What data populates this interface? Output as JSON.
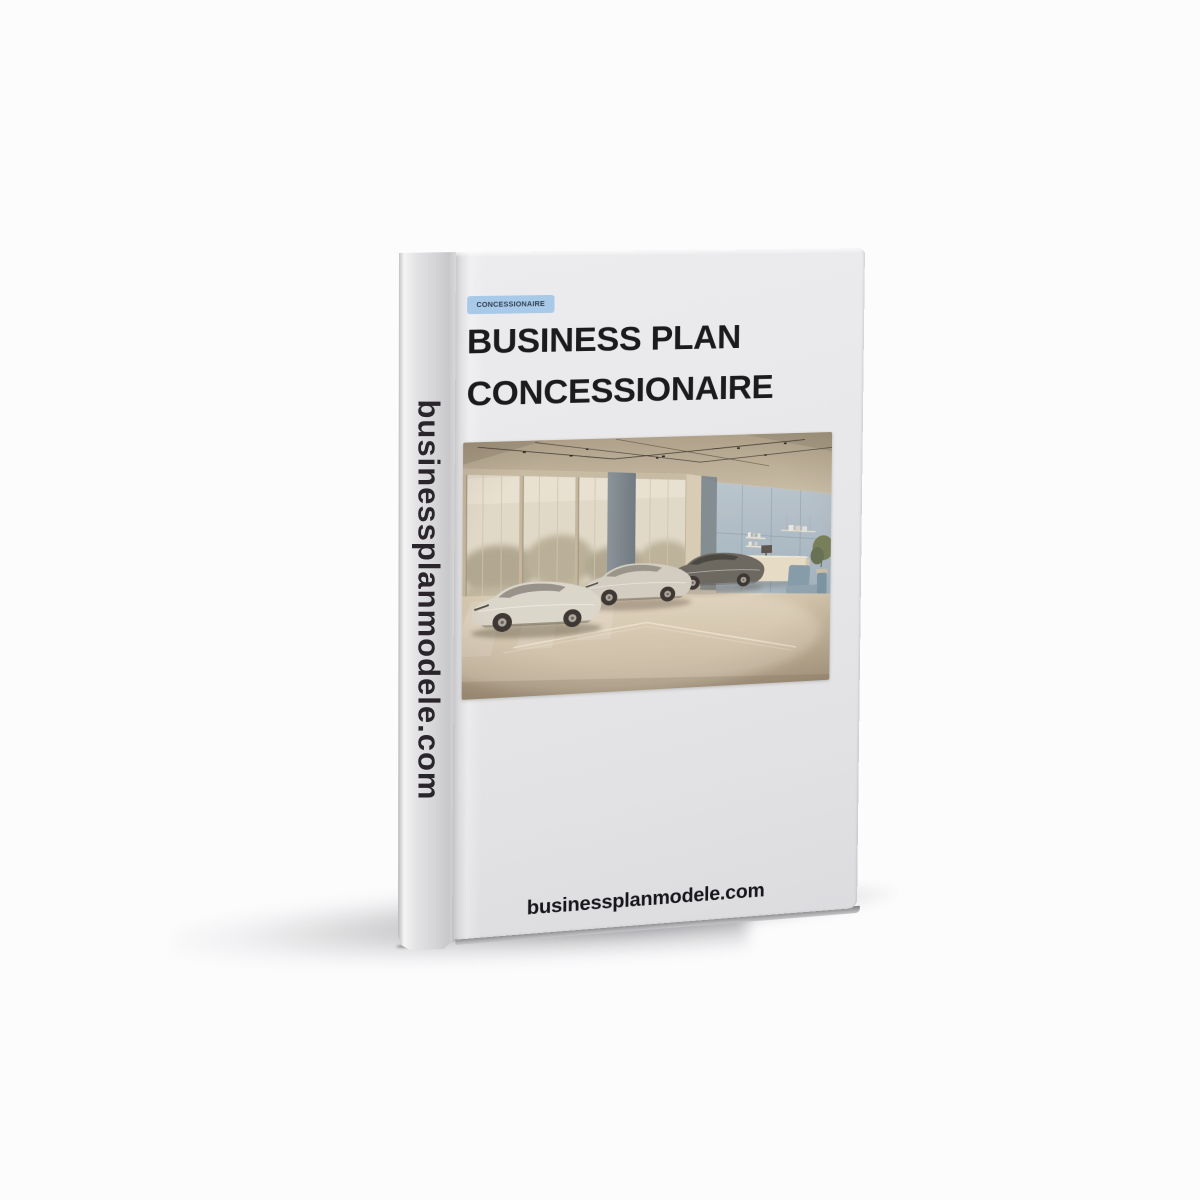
{
  "page": {
    "bg": "#fcfcfd"
  },
  "book": {
    "spine_text": "businessplanmodele.com",
    "badge": {
      "label": "CONCESSIONAIRE"
    },
    "title": {
      "line1": "BUSINESS PLAN",
      "line2": "CONCESSIONAIRE"
    },
    "website": "businessplanmodele.com",
    "colors": {
      "cover_bg": "#e7e7e9",
      "badge_bg": "#a9c9e8",
      "badge_text": "#2e3e50",
      "title_text": "#1b1b1d",
      "website_text": "#16161b",
      "spine_text_color": "#2a252b"
    },
    "cover_image": {
      "name": "car-showroom-photo",
      "description": "Three sports cars in a bright dealership showroom with large windows, blue accent wall, reception desk and armchair",
      "palette": {
        "ceiling": "#b3a68f",
        "window_glass": "#e3dccc",
        "trees": "#a59c85",
        "frame": "#c7baa4",
        "pillar": "#75828c",
        "wall_blue": "#aabbc9",
        "desk": "#e8dec9",
        "chair": "#7e98aa",
        "floor_far": "#d8ccb5",
        "floor_near": "#a99a83",
        "car_silver": "#dcd8cf",
        "car_dark": "#615e59",
        "wheel": "#2c2926"
      }
    }
  }
}
